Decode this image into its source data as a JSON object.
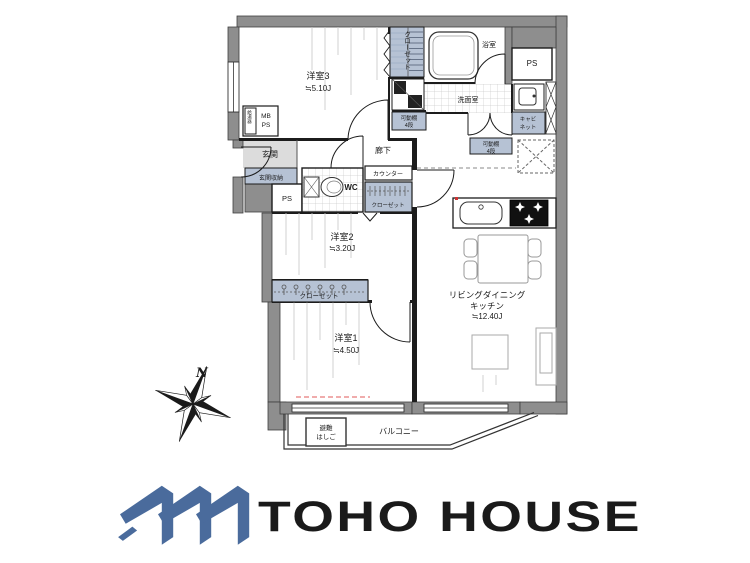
{
  "plan": {
    "bedroom3": {
      "name": "洋室3",
      "area": "≒5.10J"
    },
    "bedroom2": {
      "name": "洋室2",
      "area": "≒3.20J"
    },
    "bedroom1": {
      "name": "洋室1",
      "area": "≒4.50J"
    },
    "ldk": {
      "line1": "リビングダイニング",
      "line2": "キッチン",
      "area": "≒12.40J"
    },
    "entrance": {
      "name": "玄関",
      "storage": "玄関収納"
    },
    "corridor": "廊下",
    "washroom": "洗面室",
    "bathroom": "浴室",
    "wc": "WC",
    "balcony": "バルコニー",
    "closet_top": "クローゼット",
    "closet_mid": "クローゼット",
    "closet_bottom": "クローゼット",
    "counter": "カウンター",
    "shelf_left": {
      "line1": "可動棚",
      "line2": "4段"
    },
    "shelf_right": {
      "line1": "可動棚",
      "line2": "4段"
    },
    "cabinet": {
      "line1": "キャビ",
      "line2": "ネット"
    },
    "ps_top": "PS",
    "ps_hall": "PS",
    "meter_box": {
      "line1": "MB",
      "line2": "PS"
    },
    "water_heater": "給湯器",
    "escape": {
      "line1": "避難",
      "line2": "はしご"
    },
    "compass": "N"
  },
  "logo": {
    "text": "TOHO HOUSE",
    "color": "#4a6b9c"
  }
}
